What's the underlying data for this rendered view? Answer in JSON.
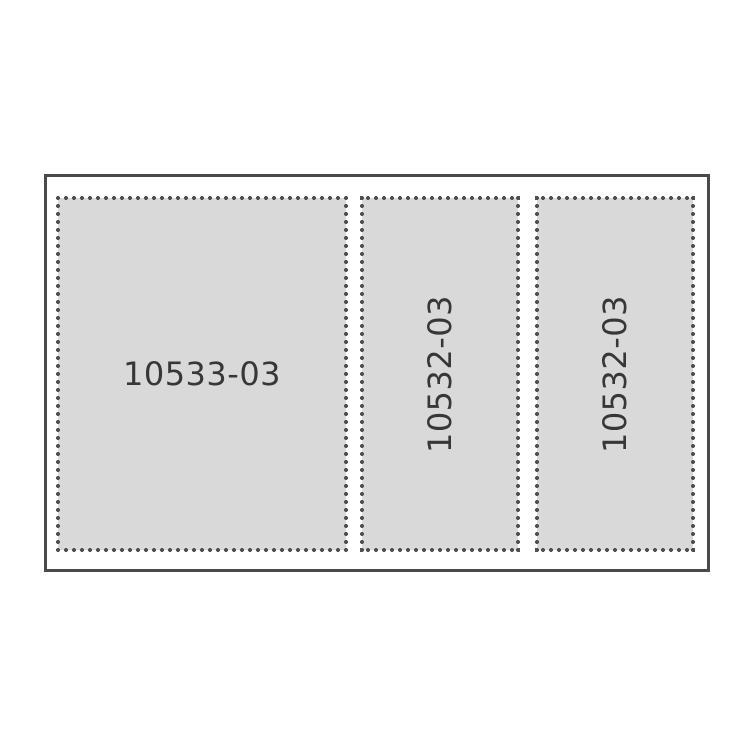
{
  "diagram": {
    "description": "Die-cut sheet layout with three perforated panels",
    "panels": [
      {
        "label": "10533-03",
        "orientation": "horizontal"
      },
      {
        "label": "10532-03",
        "orientation": "vertical"
      },
      {
        "label": "10532-03",
        "orientation": "vertical"
      }
    ]
  },
  "colors": {
    "outline": "#4a4a4a",
    "dot": "#505050",
    "fill": "#d9d9d9",
    "text": "#373737",
    "bg": "#ffffff"
  }
}
